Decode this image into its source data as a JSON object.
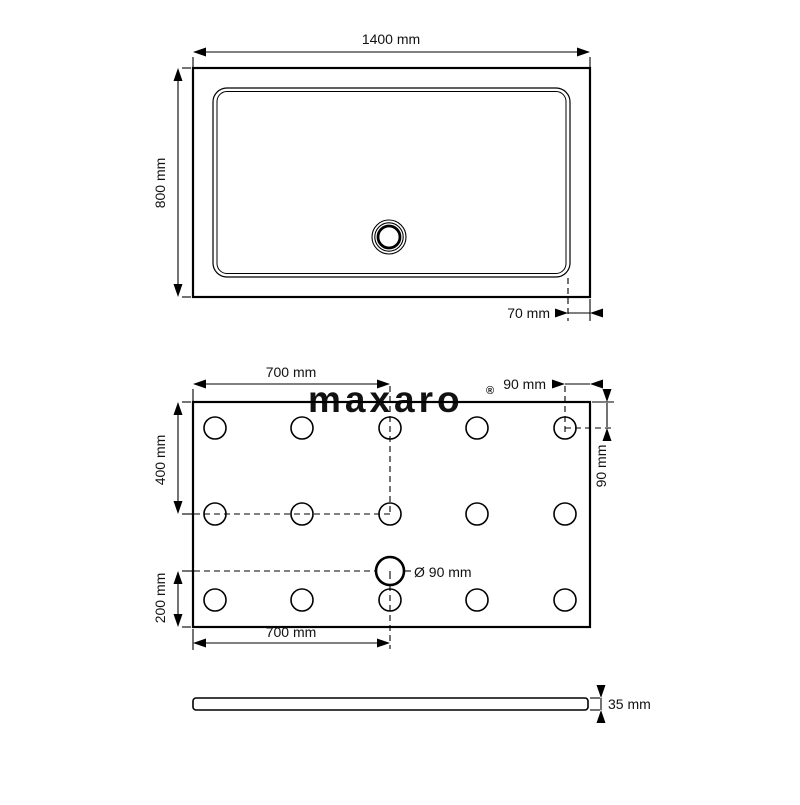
{
  "colors": {
    "line": "#000000",
    "background": "#ffffff",
    "watermark": "#ededed"
  },
  "watermark": {
    "text": "maxaro",
    "registered_mark": "®"
  },
  "top_view": {
    "width_label": "1400 mm",
    "height_label": "800 mm",
    "rim_label": "70 mm"
  },
  "bottom_view": {
    "top_span_label": "700 mm",
    "top_right_label": "90 mm",
    "right_label": "90 mm",
    "left_upper_label": "400 mm",
    "left_lower_label": "200 mm",
    "drain_label": "Ø 90 mm",
    "bottom_span_label": "700 mm",
    "feet": {
      "rows": 3,
      "columns": 5
    }
  },
  "side_view": {
    "thickness_label": "35 mm"
  }
}
